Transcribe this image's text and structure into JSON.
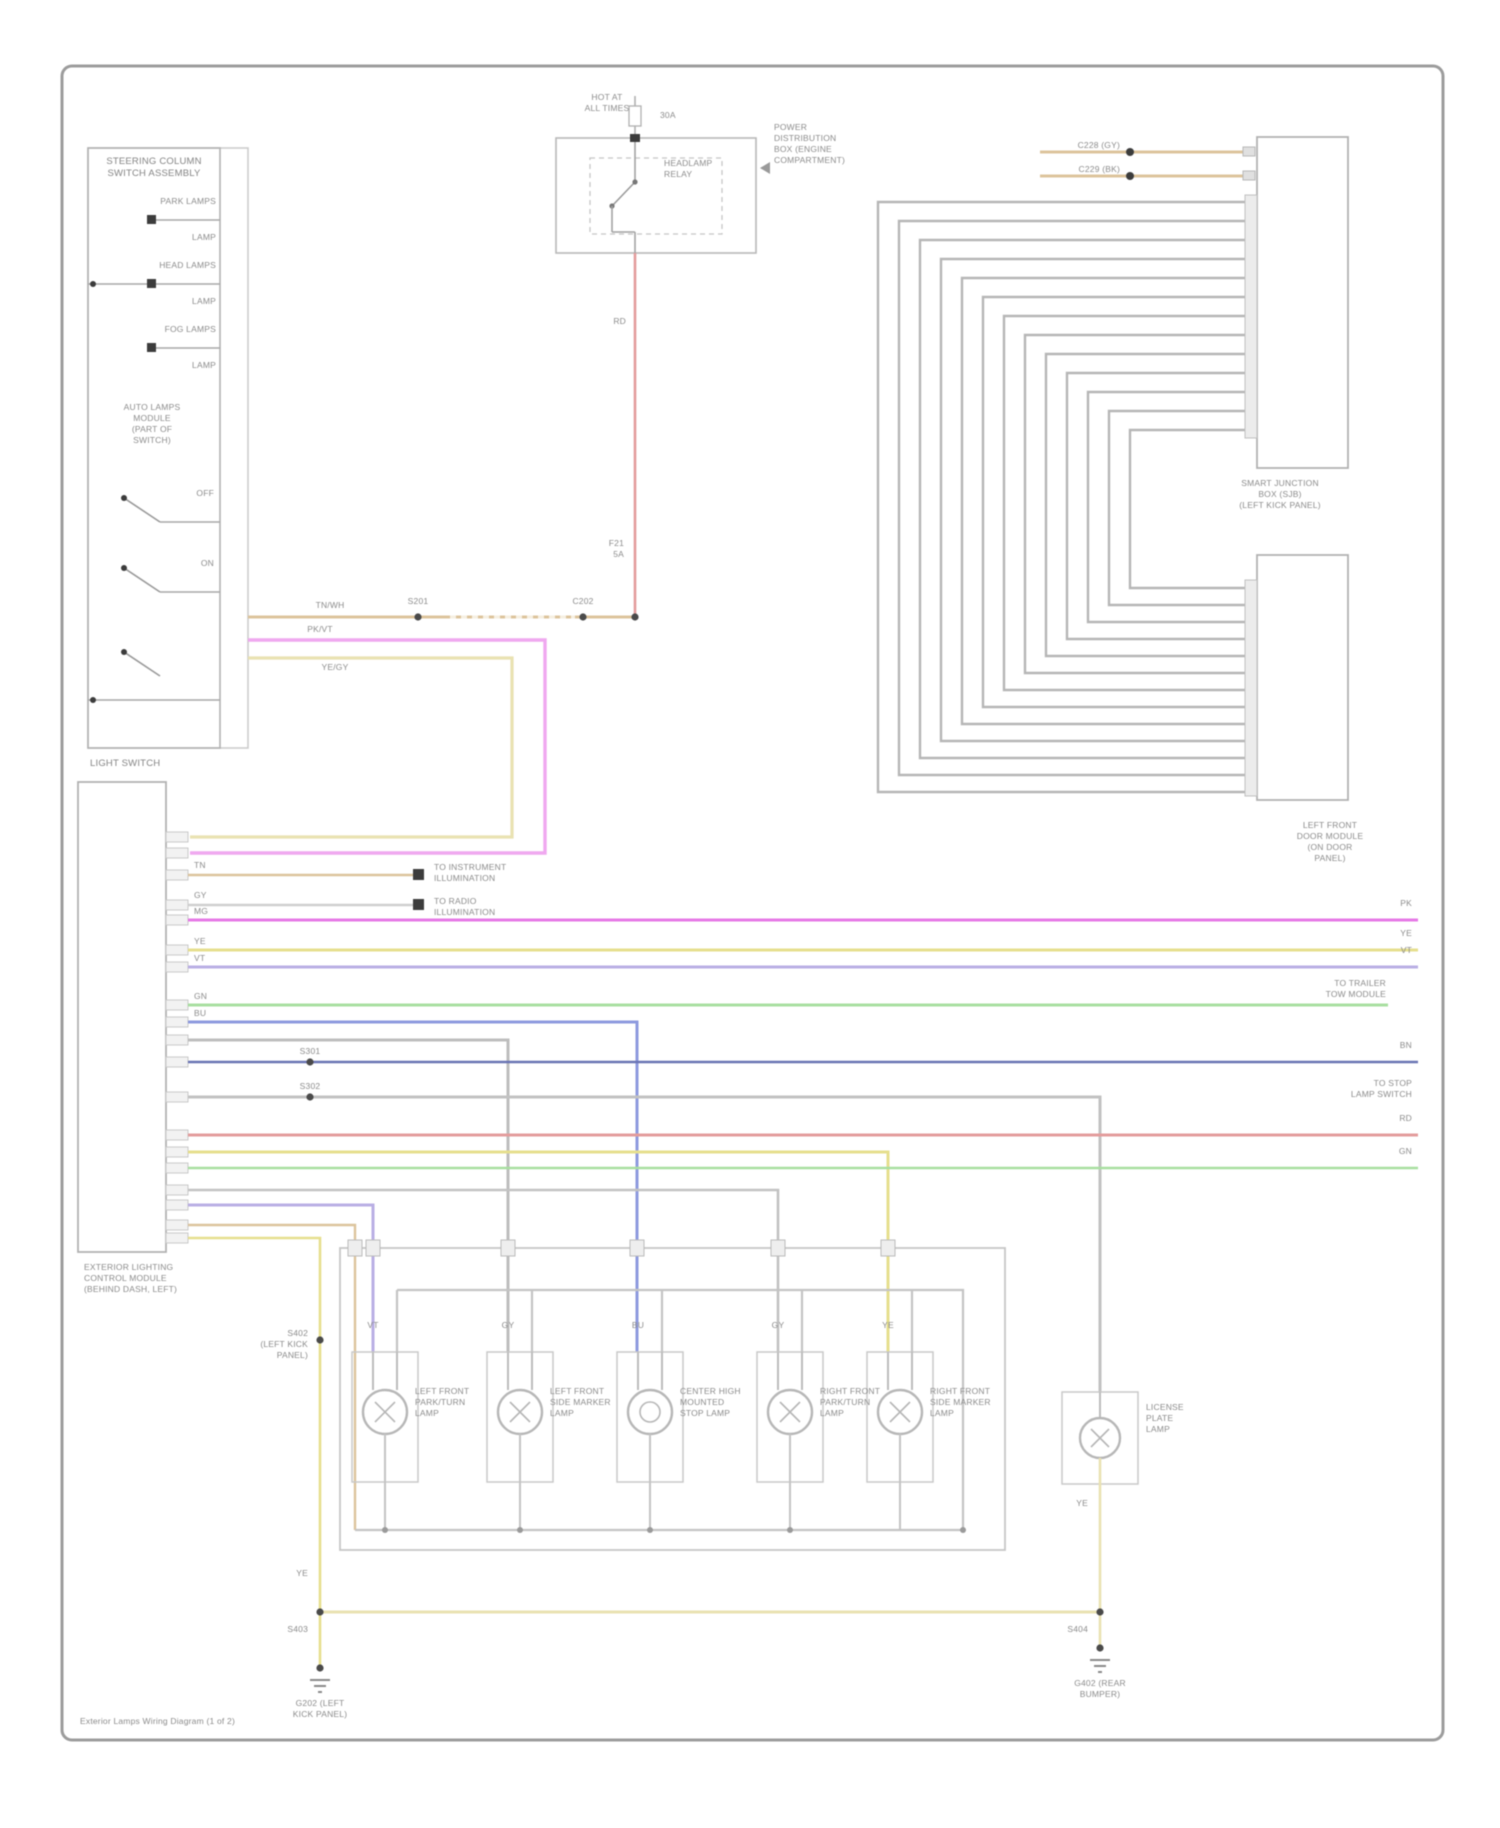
{
  "page": {
    "caption": "Exterior Lamps Wiring Diagram (1 of 2)"
  },
  "colors": {
    "border_gray": "#9c9c9c",
    "box_gray": "#b2b2b2",
    "wire_gray": "#c2c2c2",
    "tan": "#dcc49c",
    "cream": "#e9e2b2",
    "yellow": "#e6df8e",
    "magenta": "#e678e6",
    "pink": "#efa8ef",
    "violet": "#b9aee4",
    "blue": "#8e9ade",
    "navy": "#6a74b4",
    "green": "#a8dfa0",
    "red": "#e39c9c",
    "black_pin": "#3c3c3c"
  },
  "switch_assembly": {
    "title": "STEERING COLUMN\nSWITCH ASSEMBLY",
    "row1": "PARK LAMPS",
    "row1_sub": "LAMP",
    "row2": "HEAD LAMPS",
    "row2_sub": "LAMP",
    "row3": "FOG LAMPS",
    "row3_sub": "LAMP",
    "block": "AUTO LAMPS\nMODULE\n(PART OF\nSWITCH)",
    "pos1": "OFF",
    "pos2": "ON",
    "bottom": "LIGHT SWITCH"
  },
  "relay": {
    "hot": "HOT AT\nALL TIMES",
    "amp": "30A",
    "name": "HEADLAMP\nRELAY",
    "loc": "POWER\nDISTRIBUTION\nBOX (ENGINE\nCOMPARTMENT)",
    "wire": "RD",
    "fuse": "F21\n5A"
  },
  "tan_run": {
    "s1": "S201",
    "s2": "C202",
    "code": "TN/WH"
  },
  "loops": {
    "pink": "PK/VT",
    "cream": "YE/GY"
  },
  "module": {
    "label": "EXTERIOR LIGHTING\nCONTROL MODULE\n(BEHIND DASH, LEFT)",
    "code_tn": "TN",
    "code_gy": "GY",
    "code_mg": "MG",
    "code_ye": "YE",
    "code_vt": "VT",
    "code_gn": "GN",
    "code_bu": "BU",
    "s1": "S301",
    "s2": "S302",
    "conn1": "TO INSTRUMENT\nILLUMINATION",
    "conn2": "TO RADIO\nILLUMINATION"
  },
  "right_edge": {
    "pk": "PK",
    "ye": "YE",
    "vt": "VT",
    "bn": "BN",
    "rd": "RD",
    "gn": "GN",
    "stop": "TO STOP\nLAMP SWITCH",
    "trailer": "TO TRAILER\nTOW MODULE"
  },
  "coil": {
    "c1": "C228 (GY)",
    "c2": "C229 (BK)",
    "box1_label": "SMART JUNCTION\nBOX (SJB)\n(LEFT KICK PANEL)",
    "box2_label": "LEFT FRONT\nDOOR MODULE\n(ON DOOR\nPANEL)"
  },
  "lamps": {
    "splice": "S402\n(LEFT KICK\nPANEL)",
    "a": "LEFT FRONT\nPARK/TURN\nLAMP",
    "b": "LEFT FRONT\nSIDE MARKER\nLAMP",
    "c": "CENTER HIGH\nMOUNTED\nSTOP LAMP",
    "d": "RIGHT FRONT\nPARK/TURN\nLAMP",
    "e": "RIGHT FRONT\nSIDE MARKER\nLAMP",
    "r": "LICENSE\nPLATE\nLAMP",
    "feed_a": "VT",
    "feed_b": "GY",
    "feed_c": "BU",
    "feed_d": "GY",
    "feed_e": "YE"
  },
  "grounds": {
    "left_code": "YE",
    "left_s": "S403",
    "left_label": "G202 (LEFT\nKICK PANEL)",
    "right_code": "YE",
    "right_s": "S404",
    "right_label": "G402 (REAR\nBUMPER)"
  }
}
